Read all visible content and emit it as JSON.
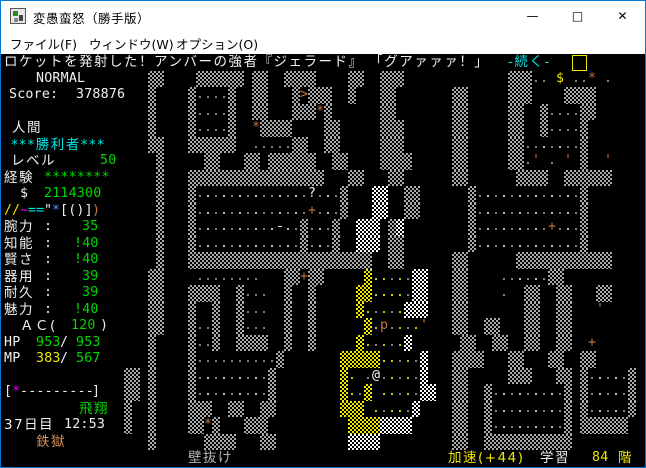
{
  "window": {
    "title": "変愚蛮怒（勝手版）",
    "controls": {
      "minimize": "—",
      "maximize": "□",
      "close": "✕"
    }
  },
  "menu": {
    "items": [
      {
        "label": "ファイル(F)",
        "x": 9
      },
      {
        "label": "ウィンドウ(W)",
        "x": 88
      },
      {
        "label": "オプション(O)",
        "x": 175
      }
    ]
  },
  "palette": {
    "white": "#f0f0f0",
    "bright": "#ffffff",
    "gray": "#b8b8b8",
    "green": "#00d800",
    "yellow": "#f0e800",
    "cyan": "#00e8e8",
    "magenta": "#e800e8",
    "umber": "#c8783c",
    "orange": "#d89058",
    "blue": "#4898ff",
    "dot": "#9a9a9a",
    "dotw": "#e0e0e0"
  },
  "message": {
    "text_main": "ロケットを発射した！アンバーの強者『ジェラード』 「グアァァァ！」",
    "text_more": "-続く-",
    "more_color": "cyan",
    "cursor": true
  },
  "sidebar": {
    "lines": [
      {
        "row": 1,
        "x": 35,
        "text": "NORMAL",
        "color": "white",
        "font": "mono"
      },
      {
        "row": 2,
        "x": 8,
        "text": "Score:",
        "color": "white",
        "font": "mono"
      },
      {
        "row": 2,
        "x": 75,
        "text": "378876",
        "color": "white",
        "font": "mono"
      },
      {
        "row": 4,
        "x": 11,
        "text": "人間",
        "color": "white",
        "font": "jp"
      },
      {
        "row": 5,
        "x": 10,
        "text": "***勝利者***",
        "color": "cyan",
        "font": "jp"
      },
      {
        "row": 6,
        "x": 10,
        "text": "レベル",
        "color": "white",
        "font": "jp"
      },
      {
        "row": 6,
        "x": 99,
        "text": "50",
        "color": "green",
        "font": "mono"
      },
      {
        "row": 7,
        "x": 3,
        "text": "経験",
        "color": "white",
        "font": "jp"
      },
      {
        "row": 7,
        "x": 43,
        "text": "********",
        "color": "green",
        "font": "mono"
      },
      {
        "row": 8,
        "x": 19,
        "text": "$",
        "color": "white",
        "font": "mono"
      },
      {
        "row": 8,
        "x": 43,
        "text": "2114300",
        "color": "green",
        "font": "mono"
      },
      {
        "row": 9,
        "x": 3,
        "text": "/",
        "color": "yellow",
        "font": "mono"
      },
      {
        "row": 9,
        "x": 11,
        "text": "/",
        "color": "yellow",
        "font": "mono"
      },
      {
        "row": 9,
        "x": 19,
        "text": "~",
        "color": "magenta",
        "font": "mono"
      },
      {
        "row": 9,
        "x": 27,
        "text": "==",
        "color": "cyan",
        "font": "mono"
      },
      {
        "row": 9,
        "x": 43,
        "text": "\"",
        "color": "white",
        "font": "mono"
      },
      {
        "row": 9,
        "x": 51,
        "text": "*",
        "color": "blue",
        "font": "mono"
      },
      {
        "row": 9,
        "x": 59,
        "text": "[()]",
        "color": "white",
        "font": "mono"
      },
      {
        "row": 9,
        "x": 91,
        "text": ")",
        "color": "umber",
        "font": "mono"
      },
      {
        "row": 10,
        "x": 3,
        "text": "腕力",
        "color": "white",
        "font": "jp"
      },
      {
        "row": 10,
        "x": 43,
        "text": ":",
        "color": "white",
        "font": "mono"
      },
      {
        "row": 10,
        "x": 81,
        "text": "35",
        "color": "green",
        "font": "mono"
      },
      {
        "row": 11,
        "x": 3,
        "text": "知能",
        "color": "white",
        "font": "jp"
      },
      {
        "row": 11,
        "x": 43,
        "text": ":",
        "color": "white",
        "font": "mono"
      },
      {
        "row": 11,
        "x": 73,
        "text": "!40",
        "color": "green",
        "font": "mono"
      },
      {
        "row": 12,
        "x": 3,
        "text": "賢さ",
        "color": "white",
        "font": "jp"
      },
      {
        "row": 12,
        "x": 43,
        "text": ":",
        "color": "white",
        "font": "mono"
      },
      {
        "row": 12,
        "x": 73,
        "text": "!40",
        "color": "green",
        "font": "mono"
      },
      {
        "row": 13,
        "x": 3,
        "text": "器用",
        "color": "white",
        "font": "jp"
      },
      {
        "row": 13,
        "x": 43,
        "text": ":",
        "color": "white",
        "font": "mono"
      },
      {
        "row": 13,
        "x": 81,
        "text": "39",
        "color": "green",
        "font": "mono"
      },
      {
        "row": 14,
        "x": 3,
        "text": "耐久",
        "color": "white",
        "font": "jp"
      },
      {
        "row": 14,
        "x": 43,
        "text": ":",
        "color": "white",
        "font": "mono"
      },
      {
        "row": 14,
        "x": 81,
        "text": "39",
        "color": "green",
        "font": "mono"
      },
      {
        "row": 15,
        "x": 3,
        "text": "魅力",
        "color": "white",
        "font": "jp"
      },
      {
        "row": 15,
        "x": 43,
        "text": ":",
        "color": "white",
        "font": "mono"
      },
      {
        "row": 15,
        "x": 73,
        "text": "!40",
        "color": "green",
        "font": "mono"
      },
      {
        "row": 16,
        "x": 19,
        "text": "ＡＣ(",
        "color": "white",
        "font": "jp"
      },
      {
        "row": 16,
        "x": 70,
        "text": "120",
        "color": "green",
        "font": "mono"
      },
      {
        "row": 16,
        "x": 99,
        "text": ")",
        "color": "white",
        "font": "mono"
      },
      {
        "row": 17,
        "x": 3,
        "text": "HP",
        "color": "white",
        "font": "mono"
      },
      {
        "row": 17,
        "x": 35,
        "text": "953",
        "color": "green",
        "font": "mono"
      },
      {
        "row": 17,
        "x": 59,
        "text": "/",
        "color": "white",
        "font": "mono"
      },
      {
        "row": 17,
        "x": 75,
        "text": "953",
        "color": "green",
        "font": "mono"
      },
      {
        "row": 18,
        "x": 3,
        "text": "MP",
        "color": "white",
        "font": "mono"
      },
      {
        "row": 18,
        "x": 35,
        "text": "383",
        "color": "yellow",
        "font": "mono"
      },
      {
        "row": 18,
        "x": 59,
        "text": "/",
        "color": "white",
        "font": "mono"
      },
      {
        "row": 18,
        "x": 75,
        "text": "567",
        "color": "green",
        "font": "mono"
      },
      {
        "row": 20,
        "x": 3,
        "text": "[",
        "color": "white",
        "font": "mono"
      },
      {
        "row": 20,
        "x": 11,
        "text": "*",
        "color": "magenta",
        "font": "mono"
      },
      {
        "row": 20,
        "x": 19,
        "text": "---------",
        "color": "white",
        "font": "mono"
      },
      {
        "row": 20,
        "x": 91,
        "text": "]",
        "color": "white",
        "font": "mono"
      },
      {
        "row": 21,
        "x": 78,
        "text": "飛翔",
        "color": "green",
        "font": "jp"
      },
      {
        "row": 22,
        "x": 3,
        "text": "37日目",
        "color": "white",
        "font": "jp"
      },
      {
        "row": 22,
        "x": 63,
        "text": "12:53",
        "color": "white",
        "font": "mono"
      },
      {
        "row": 23,
        "x": 35,
        "text": "鉄獄",
        "color": "orange",
        "font": "jp"
      }
    ]
  },
  "statusbar": {
    "segments": [
      {
        "x": 187,
        "text": "壁抜け",
        "color": "gray",
        "font": "jp"
      },
      {
        "x": 447,
        "text": "加速(+44)",
        "color": "yellow",
        "font": "jp"
      },
      {
        "x": 539,
        "text": "学習",
        "color": "white",
        "font": "jp"
      },
      {
        "x": 591,
        "text": "84",
        "color": "yellow",
        "font": "mono"
      },
      {
        "x": 617,
        "text": "階",
        "color": "yellow",
        "font": "jp"
      }
    ]
  },
  "map": {
    "origin_col": 13,
    "legend": {
      "#": "granite-wall",
      "%": "quartz-wall",
      "V": "vault-wall-yellow",
      ".": "floor-dot",
      "o": "floor-dot-lit",
      ":": "floor-dot-vault",
      "@": "player",
      "p": "human-monster",
      ">": "stairs-down",
      "+": "closed-door",
      "'": "open-door",
      "*": "treasure-vein",
      "$": "gold",
      "?": "scroll",
      "-": "wand"
    },
    "rows": [
      "     ##    ###### ##  ####    ##  ###             ###.. $ ..* .   ",
      "     #    #....#  ##   #>###  #   ##       ##     ###    ####     ",
      "     #    #....#  ##   ###*#      ##       ##     ##  #....##     ",
      "     #    #....#  *####    ##     ###      ##     ##  #....#      ",
      "     ##   ######  .....##  ##     ###      ##     ##..o.o..#      ",
      "      #     ##   ## ######  ##    ####     ##     ##.' . ' #  '   ",
      "      #   #################   ##   ##      ##      ####  ######   ",
      "      #   #.o.o.o.o..o.o.?.o.#   %%  ##      #.o.o.o.o.o.o.#      ",
      "      #   #.o.o.o.o..o.o.+.o.#   %%  ##      #.o.o.o.o.o.o.#      ",
      "      #   #.o.o.o.o.o-o.#.o.#  %%% #%        #.o.o.o.o.+.o.#      ",
      "      #   #.o.o.o.o.o.o.#.o.#  %%% ##        #.o.o.o.o.o.o.#      ",
      "      #   #######################  ##      ##      ############   ",
      "     ##    ........   ##+##     V::.:.%%   ##    ..o.o.##         ",
      "     ##   ####  #...  #  #     VV::::.%%   ##    .  ##  ##   ##   ",
      "     ##   #  #  #...  #  #     V:.:.:%%%   ##       ##  ##   '    ",
      "     ##   #..#  #...  #  #      V:p.:.:'   ##  ##   ##  ##        ",
      "     #    #..#  ####  #  #     V:.:.:%      ##  ##  ##  ##  +     ",
      "     #    #..........#       VVVVV::.:.%   ####   ##   ##  ##     ",
      "  ## #    #.o.o.o.o.#        V: .@.:.:.%   ##     ###   ## #.o.o.#",
      "  ## #    #.o.o.o.o.#        V:.V ::.:.%%  ##  #.o.o.o.o.# #.o.o.#",
      "  #  #    ###  ##  ##        VVV :.::.%    ##  #.o.o.o.o.# #.o.o.#",
      "  #  #    ##*#   ###          VVVV%%%%     ##  #.o.o.o.o.# ###### ",
      "     #      ####   ##         %%%%         ##  ###########        "
    ]
  }
}
